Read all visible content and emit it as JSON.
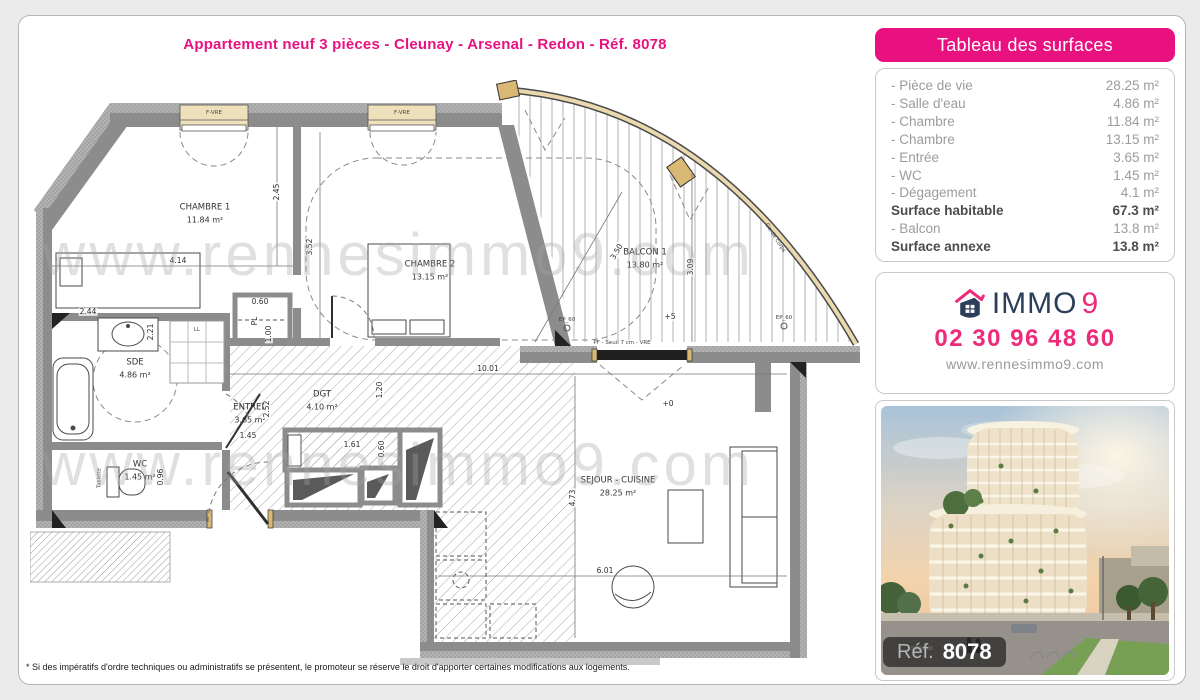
{
  "page": {
    "title": "Appartement neuf 3 pièces - Cleunay - Arsenal - Redon - Réf. 8078",
    "footnote": "* Si des impératifs d'ordre techniques ou administratifs se présentent, le promoteur se réserve le droit d'apporter certaines modifications aux logements.",
    "accent_color": "#e9117f"
  },
  "surfaces": {
    "header": "Tableau des surfaces",
    "rows": [
      {
        "label": "- Pièce de vie",
        "value": "28.25 m²"
      },
      {
        "label": "- Salle d'eau",
        "value": "4.86 m²"
      },
      {
        "label": "- Chambre",
        "value": "11.84 m²"
      },
      {
        "label": "- Chambre",
        "value": "13.15 m²"
      },
      {
        "label": "- Entrée",
        "value": "3.65 m²"
      },
      {
        "label": "- WC",
        "value": "1.45 m²"
      },
      {
        "label": "- Dégagement",
        "value": "4.1 m²"
      },
      {
        "label": "Surface habitable",
        "value": "67.3 m²"
      },
      {
        "label": "- Balcon",
        "value": "13.8 m²"
      },
      {
        "label": "Surface annexe",
        "value": "13.8 m²"
      }
    ]
  },
  "agency": {
    "brand_immo": "IMMO",
    "brand_9": "9",
    "phone": "02 30 96 48 60",
    "website": "www.rennesimmo9.com",
    "navy": "#2c3e5a",
    "pink": "#ee2a7b"
  },
  "photo": {
    "ref_label": "Réf.",
    "ref_number": "8078"
  },
  "plan": {
    "watermark": "www.rennesimmo9.com",
    "rooms": [
      {
        "name": "CHAMBRE 1",
        "area": "11.84 m²"
      },
      {
        "name": "CHAMBRE 2",
        "area": "13.15 m²"
      },
      {
        "name": "BALCON 1",
        "area": "13.80 m²"
      },
      {
        "name": "SDE",
        "area": "4.86 m²"
      },
      {
        "name": "WC",
        "area": "1.45 m²"
      },
      {
        "name": "ENTREE",
        "area": "3.65 m²"
      },
      {
        "name": "DGT",
        "area": "4.10 m²"
      },
      {
        "name": "SEJOUR - CUISINE",
        "area": "28.25 m²"
      }
    ],
    "dims": [
      "4.14",
      "2.45",
      "3.52",
      "2.44",
      "2.21",
      "0.60",
      "1.00",
      "1.45",
      "2.52",
      "1.61",
      "0.60",
      "1.20",
      "10.01",
      "4.73",
      "6.01",
      "3.50",
      "3.09",
      "0.96"
    ],
    "labels": {
      "pl": "PL",
      "level_balcony": "+5",
      "level_interior": "+0",
      "ep1": "EP_60",
      "ep2": "EP_60",
      "bay": "PF - Seuil 7 cm - VRE",
      "railing": "Garde corps",
      "window1": "F-VRE",
      "window2": "F-VRE",
      "tablette": "Tablette",
      "ll": "LL"
    }
  }
}
